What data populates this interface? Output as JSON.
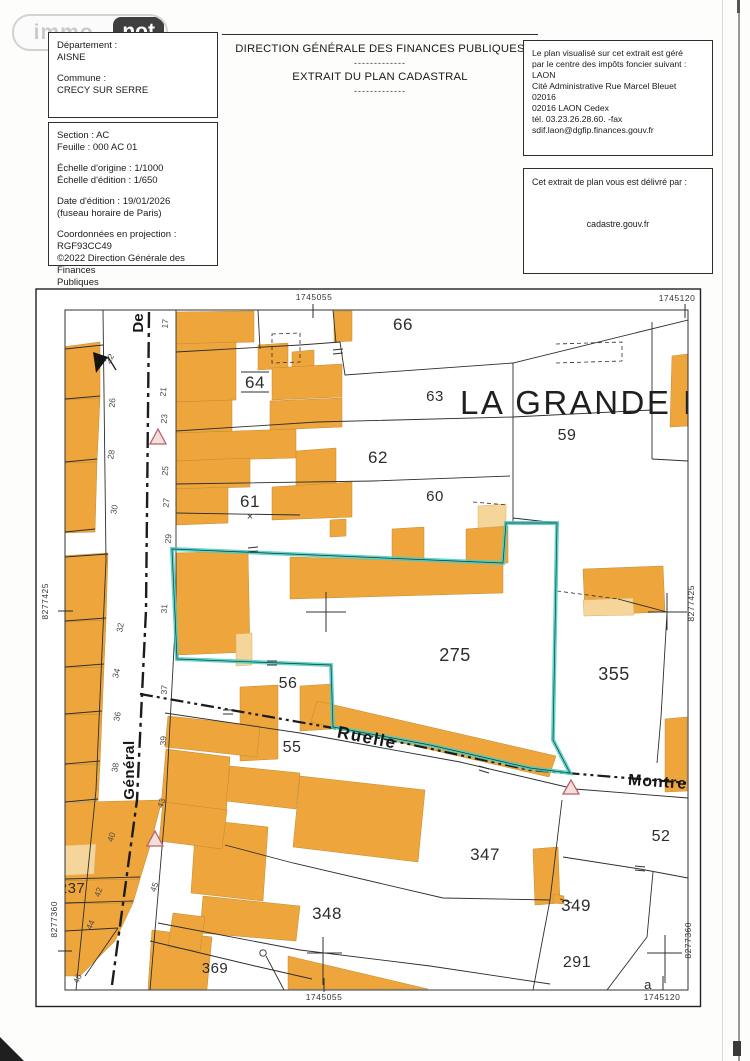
{
  "logo": {
    "immo": "immo",
    "not": "not"
  },
  "commune_box": {
    "departement_label": "Département :",
    "departement_value": "AISNE",
    "commune_label": "Commune :",
    "commune_value": "CRECY SUR SERRE"
  },
  "details_box": {
    "section": "Section : AC",
    "feuille": "Feuille : 000 AC 01",
    "echelle_origine": "Échelle d'origine : 1/1000",
    "echelle_edition": "Échelle d'édition : 1/650",
    "date_edition": "Date d'édition : 19/01/2026",
    "fuseau": "(fuseau horaire de Paris)",
    "coordonnees": "Coordonnées en projection : RGF93CC49",
    "copyright1": "©2022 Direction Générale des Finances",
    "copyright2": "Publiques"
  },
  "center_header": {
    "title1": "DIRECTION GÉNÉRALE DES FINANCES PUBLIQUES",
    "separator1": "-------------",
    "title2": "EXTRAIT DU PLAN CADASTRAL",
    "separator2": "-------------"
  },
  "cdif_box": {
    "line1": "Le plan visualisé sur cet extrait est géré",
    "line2": "par le centre des impôts foncier suivant :",
    "line3": "LAON",
    "line4": "Cité Administrative Rue Marcel Bleuet",
    "line5": "02016",
    "line6": "02016 LAON  Cedex",
    "line7": "tél. 03.23.26.28.60. -fax",
    "line8": "sdif.laon@dgfip.finances.gouv.fr"
  },
  "delivery_box": {
    "title": "Cet extrait de plan vous est délivré par :",
    "site": "cadastre.gouv.fr"
  },
  "map": {
    "grid_labels": {
      "top_left": "1745055",
      "top_right": "1745120",
      "bottom_left": "1745055",
      "bottom_right": "1745120",
      "left_upper": "8277425",
      "left_lower": "8277360",
      "right_upper": "8277425",
      "right_lower": "8277360"
    },
    "big_street_label": "LA GRANDE RUE",
    "street_labels": [
      {
        "t": "De",
        "x": 143,
        "y": 323,
        "r": -90,
        "s": 15,
        "ls": 0
      },
      {
        "t": "Général",
        "x": 134,
        "y": 770,
        "r": -90,
        "s": 15,
        "ls": 0.5
      },
      {
        "t": "Ruelle",
        "x": 366,
        "y": 743,
        "r": 11,
        "s": 17,
        "ls": 1.5
      },
      {
        "t": "Montrel",
        "x": 660,
        "y": 787,
        "r": 4,
        "s": 16,
        "ls": 1
      }
    ],
    "parcel_labels": [
      {
        "t": "66",
        "x": 403,
        "y": 330,
        "s": 17
      },
      {
        "t": "64",
        "x": 255,
        "y": 388,
        "s": 17,
        "bars": true
      },
      {
        "t": "63",
        "x": 435,
        "y": 401,
        "s": 15
      },
      {
        "t": "62",
        "x": 378,
        "y": 463,
        "s": 17
      },
      {
        "t": "61",
        "x": 250,
        "y": 507,
        "s": 17
      },
      {
        "t": "60",
        "x": 435,
        "y": 501,
        "s": 15
      },
      {
        "t": "59",
        "x": 567,
        "y": 440,
        "s": 16
      },
      {
        "t": "275",
        "x": 455,
        "y": 661,
        "s": 18
      },
      {
        "t": "355",
        "x": 614,
        "y": 680,
        "s": 18
      },
      {
        "t": "56",
        "x": 288,
        "y": 688,
        "s": 16
      },
      {
        "t": "55",
        "x": 292,
        "y": 752,
        "s": 16
      },
      {
        "t": "347",
        "x": 485,
        "y": 860,
        "s": 17
      },
      {
        "t": "348",
        "x": 327,
        "y": 919,
        "s": 17
      },
      {
        "t": "349",
        "x": 576,
        "y": 911,
        "s": 17
      },
      {
        "t": "291",
        "x": 577,
        "y": 967,
        "s": 16
      },
      {
        "t": "52",
        "x": 661,
        "y": 841,
        "s": 16
      },
      {
        "t": "237",
        "x": 72,
        "y": 893,
        "s": 15
      },
      {
        "t": "95",
        "x": 58,
        "y": 915,
        "s": 14
      },
      {
        "t": "369",
        "x": 215,
        "y": 973,
        "s": 15
      },
      {
        "t": "a",
        "x": 648,
        "y": 989,
        "s": 13
      }
    ],
    "house_numbers": [
      {
        "t": "22",
        "x": 112,
        "y": 360,
        "r": -60
      },
      {
        "t": "26",
        "x": 115,
        "y": 403,
        "r": -85
      },
      {
        "t": "28",
        "x": 114,
        "y": 455,
        "r": -80
      },
      {
        "t": "30",
        "x": 117,
        "y": 510,
        "r": -80
      },
      {
        "t": "32",
        "x": 123,
        "y": 628,
        "r": -80
      },
      {
        "t": "34",
        "x": 119,
        "y": 674,
        "r": -75
      },
      {
        "t": "36",
        "x": 120,
        "y": 717,
        "r": -80
      },
      {
        "t": "38",
        "x": 118,
        "y": 768,
        "r": -80
      },
      {
        "t": "40",
        "x": 114,
        "y": 838,
        "r": -70
      },
      {
        "t": "42",
        "x": 101,
        "y": 893,
        "r": -70
      },
      {
        "t": "44",
        "x": 93,
        "y": 926,
        "r": -65
      },
      {
        "t": "46",
        "x": 80,
        "y": 980,
        "r": -65
      },
      {
        "t": "17",
        "x": 168,
        "y": 324,
        "r": -85
      },
      {
        "t": "21",
        "x": 166,
        "y": 392,
        "r": -85
      },
      {
        "t": "23",
        "x": 167,
        "y": 419,
        "r": -85
      },
      {
        "t": "25",
        "x": 168,
        "y": 471,
        "r": -85
      },
      {
        "t": "27",
        "x": 169,
        "y": 503,
        "r": -85
      },
      {
        "t": "29",
        "x": 171,
        "y": 539,
        "r": -85
      },
      {
        "t": "31",
        "x": 167,
        "y": 609,
        "r": -85
      },
      {
        "t": "37",
        "x": 167,
        "y": 690,
        "r": -85
      },
      {
        "t": "39",
        "x": 166,
        "y": 741,
        "r": -85
      },
      {
        "t": "43",
        "x": 164,
        "y": 804,
        "r": -70
      },
      {
        "t": "45",
        "x": 157,
        "y": 888,
        "r": -70
      }
    ],
    "symbols": {
      "parcel_cross": "×"
    },
    "colors": {
      "building": "#eea63c",
      "building_light": "#f6d59a",
      "selection": "#3fd0c5",
      "triangle_stroke": "#b5646a",
      "line": "#2e2e2e"
    }
  }
}
